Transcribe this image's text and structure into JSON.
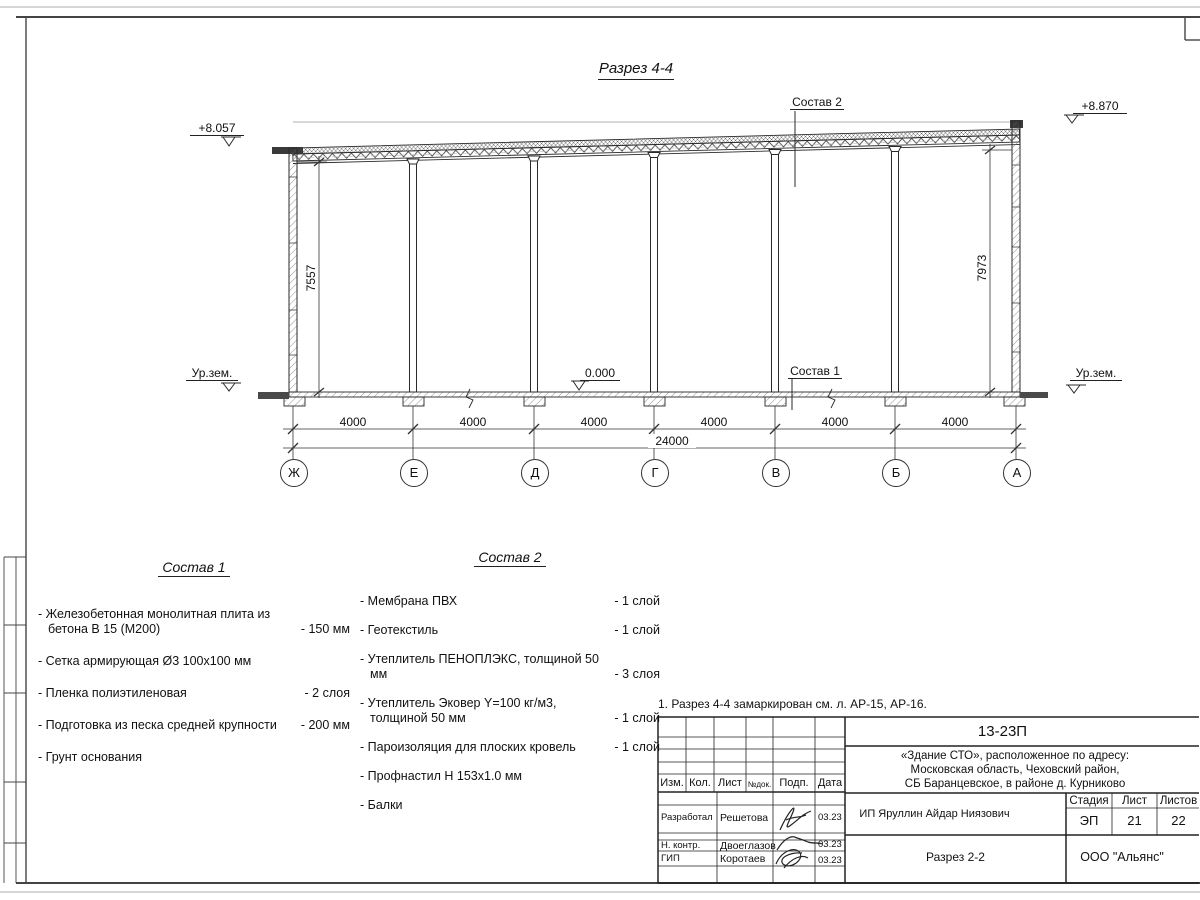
{
  "drawing": {
    "title": "Разрез 4-4",
    "elevations": {
      "left": "+8.057",
      "right": "+8.870",
      "zero": "0.000",
      "ground_left": "Ур.зем.",
      "ground_right": "Ур.зем."
    },
    "leaders": {
      "sostav1": "Состав 1",
      "sostav2": "Состав 2"
    },
    "dims": {
      "left_height": "7557",
      "right_height": "7973",
      "spans": [
        "4000",
        "4000",
        "4000",
        "4000",
        "4000",
        "4000"
      ],
      "total": "24000"
    },
    "axes": [
      "Ж",
      "Е",
      "Д",
      "Г",
      "В",
      "Б",
      "А"
    ]
  },
  "sostav1": {
    "title": "Состав 1",
    "items": [
      {
        "name": "- Железобетонная  монолитная плита\nиз бетона В 15 (М200)",
        "value": "- 150 мм"
      },
      {
        "name": "- Сетка армирующая Ø3 100х100 мм",
        "value": ""
      },
      {
        "name": "- Пленка полиэтиленовая",
        "value": "-  2 слоя"
      },
      {
        "name": "- Подготовка из песка средней\nкрупности",
        "value": "- 200 мм"
      },
      {
        "name": "- Грунт основания",
        "value": ""
      }
    ]
  },
  "sostav2": {
    "title": "Состав 2",
    "items": [
      {
        "name": "- Мембрана ПВХ",
        "value": "- 1 слой"
      },
      {
        "name": "- Геотекстиль",
        "value": "- 1 слой"
      },
      {
        "name": "- Утеплитель ПЕНОПЛЭКС,\nтолщиной 50 мм",
        "value": "- 3 слоя"
      },
      {
        "name": "- Утеплитель Эковер Y=100 кг/м3,\nтолщиной 50 мм",
        "value": "- 1 слой"
      },
      {
        "name": "- Пароизоляция для плоских кровель",
        "value": "- 1 слой"
      },
      {
        "name": "- Профнастил Н 153х1.0 мм",
        "value": ""
      },
      {
        "name": "- Балки",
        "value": ""
      }
    ]
  },
  "note": "1. Разрез 4-4 замаркирован см. л. АР-15, АР-16.",
  "titleblock": {
    "doc_number": "13-23П",
    "object_lines": "«Здание СТО», расположенное по адресу:\nМосковская область, Чеховский район,\nСБ Баранцевское, в районе д. Курниково",
    "rev_header": {
      "izm": "Изм.",
      "kol": "Кол.",
      "list": "Лист",
      "ndok": "№док.",
      "podp": "Подп.",
      "data": "Дата"
    },
    "signers": [
      {
        "role": "Разработал",
        "name": "Решетова",
        "date": "03.23"
      },
      {
        "role": "Н. контр.",
        "name": "Двоеглазов",
        "date": "03.23"
      },
      {
        "role": "ГИП",
        "name": "Коротаев",
        "date": "03.23"
      }
    ],
    "client": "ИП Яруллин Айдар Ниязович",
    "stage_header": {
      "stage": "Стадия",
      "sheet": "Лист",
      "sheets": "Листов"
    },
    "stage": "ЭП",
    "sheet": "21",
    "sheets": "22",
    "sheet_title": "Разрез 2-2",
    "company": "ООО \"Альянс\""
  }
}
